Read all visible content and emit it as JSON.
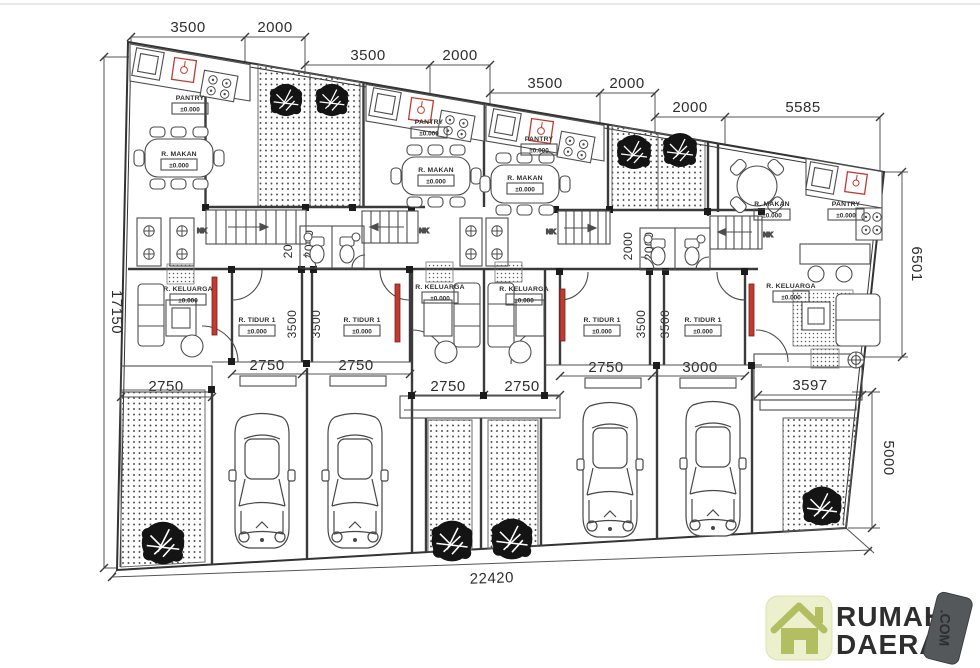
{
  "title": "Row house site floor plan",
  "dimensions": {
    "top": [
      "3500",
      "2000",
      "3500",
      "2000",
      "3500",
      "2000",
      "2000",
      "5585"
    ],
    "left": "17150",
    "right_upper": "6501",
    "right_lower": "5000",
    "bottom": "22420",
    "widths": [
      "2750",
      "2750",
      "2750",
      "2750",
      "2750",
      "2750",
      "3000",
      "3597"
    ],
    "bedroom_depth": "3500",
    "wc_depth": "2000"
  },
  "rooms": {
    "pantry": "PANTRY",
    "dining": "R. MAKAN",
    "living": "R. KELUARGA",
    "bedroom": "R. TIDUR 1",
    "level": "±0.000",
    "stair": "NK"
  },
  "logo": {
    "word1": "RUMAH",
    "word2": "DAERAH",
    "tag": ".COM"
  },
  "colors": {
    "line": "#3a3a3a",
    "accent_red": "#c13b2e",
    "logo_blue": "#41a8da",
    "logo_orange": "#f0802e",
    "tag_bg": "#54585b",
    "icon_bg": "#edf0cd",
    "icon_fg": "#b3bd62"
  }
}
